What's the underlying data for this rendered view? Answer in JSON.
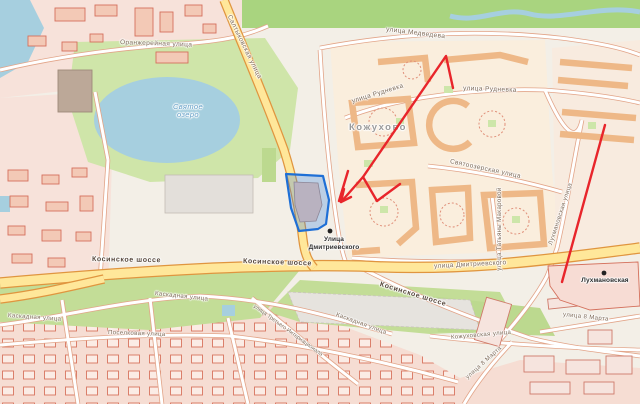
{
  "map": {
    "district": "Кожухово",
    "lake": {
      "line1": "Святое",
      "line2": "озеро"
    },
    "streets": {
      "oranzhereynaya": "Оранжерейная улица",
      "saltykovskaya": "Салтыковская улица",
      "medvedeva": "улица Медведева",
      "rudnevka1": "улица Рудневка",
      "rudnevka2": "улица Рудневка",
      "svyatoozerskaya": "Святоозерская улица",
      "tatyany_makarovoy": "улица Татьяны Макаровой",
      "dmitrievskogo": "улица Дмитриевского",
      "lukhmanovskaya": "Лухмановская улица",
      "kosinskoe1": "Косинское шоссе",
      "kosinskoe2": "Косинское шоссе",
      "kosinskoe3": "Косинское шоссе",
      "kaskadnaya1": "Каскадная улица",
      "kaskadnaya2": "Каскадная улица",
      "kaskadnaya3": "Каскадная улица",
      "poselkovaya": "Поселковая улица",
      "tretyego": "улица Третьего Интернационала",
      "marta1": "улица 8 Марта",
      "marta2": "улица 8 Марта",
      "kozhukhovskaya": "Кожуховская улица"
    },
    "stations": {
      "dmitrievskogo": {
        "line1": "Улица",
        "line2": "Дмитриевского"
      },
      "lukhmanovskaya": "Лухмановская"
    },
    "colors": {
      "annotation_red": "#e8252b",
      "selection_blue": "#1e6fd6",
      "selection_fill": "rgba(42,125,225,0.28)",
      "highway_yellow": "#ffe79a",
      "water_blue": "#a6cfdf",
      "green": "#cfe5a9",
      "land": "#f3efe7"
    }
  }
}
